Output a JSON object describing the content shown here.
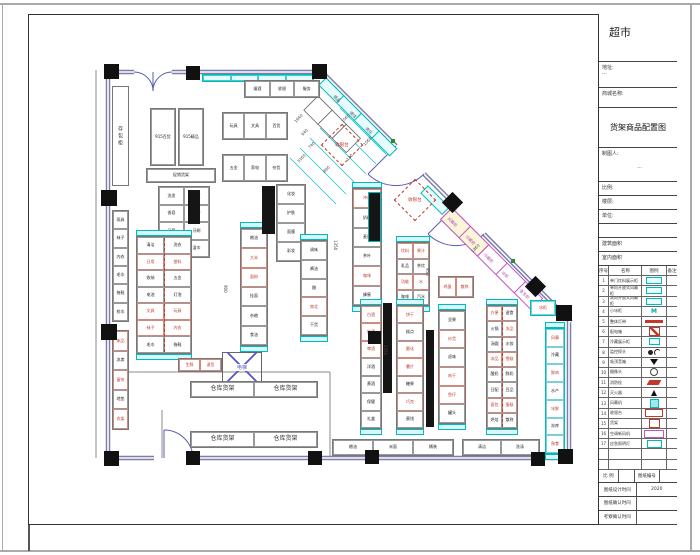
{
  "titleblock": {
    "store_title": "超市",
    "address_label": "地址:",
    "address_value": "···",
    "mall_label": "商城名称:",
    "drawing_title": "货架商品配置图",
    "drafter_label": "制图人:",
    "drafter_value": "···",
    "info_rows": [
      "比例:",
      "楼层:",
      "单位:",
      "",
      "建筑面积",
      "室内面积"
    ],
    "legend": {
      "headers": [
        "序号",
        "名称",
        "图例",
        "备注"
      ],
      "rows": [
        {
          "no": "1",
          "name": "单门饮料展示柜",
          "sym": "cyanbox",
          "note": ""
        },
        {
          "no": "2",
          "name": "单向开放式风幕柜",
          "sym": "cyanbox",
          "note": ""
        },
        {
          "no": "3",
          "name": "双向开放式风幕柜",
          "sym": "cyanbox",
          "note": ""
        },
        {
          "no": "4",
          "name": "小冰柜",
          "sym": "m",
          "note": ""
        },
        {
          "no": "5",
          "name": "整体灯带",
          "sym": "redline",
          "note": ""
        },
        {
          "no": "6",
          "name": "配电箱",
          "sym": "redhatch",
          "note": ""
        },
        {
          "no": "7",
          "name": "冷藏展示柜",
          "sym": "cyansmall",
          "note": ""
        },
        {
          "no": "8",
          "name": "监控探头",
          "sym": "dotarc",
          "note": ""
        },
        {
          "no": "9",
          "name": "吸顶音箱",
          "sym": "speaker",
          "note": ""
        },
        {
          "no": "10",
          "name": "摄像头",
          "sym": "ring",
          "note": ""
        },
        {
          "no": "11",
          "name": "消防栓",
          "sym": "redpara",
          "note": ""
        },
        {
          "no": "12",
          "name": "灭火器",
          "sym": "blacktri",
          "note": ""
        },
        {
          "no": "13",
          "name": "风幕机",
          "sym": "cyanfill",
          "note": ""
        },
        {
          "no": "14",
          "name": "收银台",
          "sym": "redoutline",
          "note": ""
        },
        {
          "no": "15",
          "name": "货架",
          "sym": "redbox",
          "note": ""
        },
        {
          "no": "16",
          "name": "空调新风机",
          "sym": "magenta",
          "note": ""
        },
        {
          "no": "17",
          "name": "应急照明灯",
          "sym": "cyanoutline",
          "note": ""
        },
        {
          "no": "",
          "name": "",
          "sym": "none",
          "note": ""
        },
        {
          "no": "",
          "name": "",
          "sym": "none",
          "note": ""
        }
      ]
    },
    "footer_rows": [
      {
        "cells": [
          "比 例",
          "",
          "图纸编号",
          ""
        ],
        "widths": [
          20,
          16,
          26,
          17
        ]
      },
      {
        "cells": [
          "图纸设计时间",
          "2020"
        ],
        "widths": [
          38,
          41
        ]
      },
      {
        "cells": [
          "图纸确认时间",
          ""
        ],
        "widths": [
          38,
          41
        ]
      },
      {
        "cells": [
          "考察确认时间",
          ""
        ],
        "widths": [
          38,
          41
        ]
      }
    ]
  },
  "plan": {
    "labels": {
      "checkout": "收银台",
      "elevator": "电梯",
      "locker": "存包柜"
    },
    "fridge_run": [
      "风幕柜",
      "冷藏柜",
      "冷藏柜",
      "冰柜",
      "急冻柜"
    ],
    "diag_top": [
      "纸品",
      "清洁",
      "洗化"
    ],
    "runs": [
      {
        "x": 202,
        "y": 74,
        "w": 112,
        "h": 8,
        "dir": "h",
        "cls": "cyan",
        "labels": [
          "",
          "",
          "",
          ""
        ]
      },
      {
        "x": 244,
        "y": 80,
        "w": 76,
        "h": 18,
        "dir": "h",
        "labels": [
          "烟酒",
          "收银",
          "服务"
        ]
      },
      {
        "x": 150,
        "y": 108,
        "w": 26,
        "h": 58,
        "dir": "h",
        "labels": [
          "915百货"
        ]
      },
      {
        "x": 178,
        "y": 108,
        "w": 26,
        "h": 58,
        "dir": "h",
        "labels": [
          "915精品"
        ]
      },
      {
        "x": 146,
        "y": 168,
        "w": 70,
        "h": 15,
        "dir": "h",
        "labels": [
          "促销货架"
        ]
      },
      {
        "x": 222,
        "y": 112,
        "w": 66,
        "h": 28,
        "dir": "h",
        "labels": [
          "玩具",
          "文具",
          "百货"
        ]
      },
      {
        "x": 222,
        "y": 154,
        "w": 66,
        "h": 28,
        "dir": "h",
        "labels": [
          "五金",
          "家电",
          "杂货"
        ]
      },
      {
        "x": 158,
        "y": 186,
        "w": 52,
        "h": 72,
        "cols": 2,
        "labels": [
          "洗发",
          "护发",
          "香皂",
          "沐浴",
          "牙膏",
          "牙刷",
          "纸品",
          "湿巾"
        ]
      },
      {
        "x": 276,
        "y": 184,
        "w": 30,
        "h": 78,
        "cols": 1,
        "labels": [
          "化妆",
          "护肤",
          "面膜",
          "彩妆"
        ]
      },
      {
        "x": 136,
        "y": 236,
        "w": 56,
        "h": 118,
        "cols": 2,
        "caps": 1,
        "mid": 1,
        "red": [
          2,
          3,
          8,
          9,
          10,
          11
        ],
        "labels": [
          "清洁",
          "洗衣",
          "日用",
          "塑料",
          "收纳",
          "五金",
          "电池",
          "灯泡",
          "文具",
          "玩具",
          "袜子",
          "内衣",
          "毛巾",
          "拖鞋"
        ]
      },
      {
        "x": 240,
        "y": 228,
        "w": 28,
        "h": 118,
        "cols": 1,
        "caps": 1,
        "red": [
          1,
          2
        ],
        "labels": [
          "粮油",
          "大米",
          "面粉",
          "挂面",
          "杂粮",
          "食油"
        ]
      },
      {
        "x": 300,
        "y": 240,
        "w": 28,
        "h": 96,
        "cols": 1,
        "caps": 1,
        "red": [
          3
        ],
        "labels": [
          "调味",
          "酱油",
          "醋",
          "南北",
          "干货"
        ]
      },
      {
        "x": 352,
        "y": 188,
        "w": 30,
        "h": 118,
        "cols": 1,
        "caps": 1,
        "red": [
          0,
          4
        ],
        "labels": [
          "冲调",
          "奶粉",
          "麦片",
          "茶叶",
          "咖啡",
          "蜂蜜"
        ]
      },
      {
        "x": 396,
        "y": 242,
        "w": 34,
        "h": 64,
        "cols": 2,
        "caps": 1,
        "red": [
          0,
          1,
          4,
          5
        ],
        "labels": [
          "饮料",
          "果汁",
          "乳品",
          "茶饮",
          "功能",
          "水",
          "咖啡",
          "汽水"
        ]
      },
      {
        "x": 360,
        "y": 305,
        "w": 22,
        "h": 124,
        "cols": 1,
        "caps": 1,
        "red": [
          0,
          1,
          2
        ],
        "labels": [
          "白酒",
          "红酒",
          "啤酒",
          "洋酒",
          "黄酒",
          "保健",
          "礼盒"
        ]
      },
      {
        "x": 396,
        "y": 305,
        "w": 28,
        "h": 124,
        "cols": 1,
        "caps": 1,
        "red": [
          0,
          2,
          3,
          5
        ],
        "labels": [
          "饼干",
          "糕点",
          "膨化",
          "薯片",
          "糖果",
          "巧克",
          "蜜饯"
        ]
      },
      {
        "x": 438,
        "y": 310,
        "w": 28,
        "h": 114,
        "cols": 1,
        "caps": 1,
        "red": [
          1,
          3,
          4
        ],
        "labels": [
          "坚果",
          "炒货",
          "卤味",
          "肉干",
          "鱼仔",
          "罐头"
        ]
      },
      {
        "x": 486,
        "y": 305,
        "w": 32,
        "h": 124,
        "cols": 2,
        "caps": 1,
        "mid": 1,
        "red": [
          0,
          3,
          6,
          7,
          12,
          13
        ],
        "labels": [
          "方便",
          "速食",
          "火锅",
          "冻品",
          "汤圆",
          "水饺",
          "冰品",
          "雪糕",
          "酸奶",
          "鲜奶",
          "日配",
          "豆品",
          "面包",
          "蛋糕",
          "烘焙",
          "散称"
        ]
      },
      {
        "x": 545,
        "y": 328,
        "w": 20,
        "h": 126,
        "cols": 1,
        "caps": 1,
        "cls": "cyan2",
        "red": [
          0,
          2,
          4,
          6
        ],
        "labels": [
          "风幕",
          "冷藏",
          "鲜肉",
          "水产",
          "冰鲜",
          "冻库",
          "熟食"
        ]
      },
      {
        "x": 332,
        "y": 439,
        "w": 122,
        "h": 17,
        "dir": "h",
        "labels": [
          "粮油",
          "米面",
          "桶装"
        ]
      },
      {
        "x": 462,
        "y": 439,
        "w": 78,
        "h": 17,
        "dir": "h",
        "labels": [
          "清洁",
          "洗涤"
        ]
      },
      {
        "x": 190,
        "y": 381,
        "w": 128,
        "h": 17,
        "dir": "h",
        "cls": "wf",
        "labels": [
          "仓库货架",
          "仓库货架"
        ]
      },
      {
        "x": 190,
        "y": 431,
        "w": 128,
        "h": 17,
        "dir": "h",
        "cls": "wf",
        "labels": [
          "仓库货架",
          "仓库货架"
        ]
      },
      {
        "x": 178,
        "y": 358,
        "w": 44,
        "h": 14,
        "dir": "h",
        "red": [
          0,
          1
        ],
        "labels": [
          "生鲜",
          "退货"
        ]
      },
      {
        "x": 112,
        "y": 210,
        "w": 17,
        "h": 112,
        "cols": 1,
        "labels": [
          "雨具",
          "袜子",
          "内衣",
          "毛巾",
          "拖鞋",
          "枕巾"
        ]
      },
      {
        "x": 112,
        "y": 330,
        "w": 17,
        "h": 100,
        "cols": 1,
        "red": [
          0,
          2,
          4
        ],
        "labels": [
          "床品",
          "凉席",
          "窗帘",
          "地垫",
          "衣架"
        ]
      },
      {
        "x": 438,
        "y": 276,
        "w": 36,
        "h": 22,
        "dir": "h",
        "red": [
          0,
          1
        ],
        "labels": [
          "鸡蛋",
          "散称"
        ]
      },
      {
        "x": 530,
        "y": 300,
        "w": 26,
        "h": 16,
        "dir": "h",
        "cls": "cyan2",
        "red": [
          0
        ],
        "labels": [
          "冰柜"
        ]
      }
    ],
    "bars": [
      {
        "x": 188,
        "y": 190,
        "w": 12,
        "h": 34
      },
      {
        "x": 262,
        "y": 186,
        "w": 13,
        "h": 48
      },
      {
        "x": 368,
        "y": 192,
        "w": 13,
        "h": 50,
        "c": 1
      },
      {
        "x": 383,
        "y": 303,
        "w": 9,
        "h": 90
      },
      {
        "x": 426,
        "y": 330,
        "w": 8,
        "h": 97
      }
    ],
    "columns": [
      {
        "x": 104,
        "y": 64,
        "s": 15
      },
      {
        "x": 186,
        "y": 66,
        "s": 14
      },
      {
        "x": 312,
        "y": 64,
        "s": 15
      },
      {
        "x": 101,
        "y": 190,
        "s": 16
      },
      {
        "x": 101,
        "y": 324,
        "s": 16
      },
      {
        "x": 104,
        "y": 451,
        "s": 15
      },
      {
        "x": 186,
        "y": 451,
        "s": 14
      },
      {
        "x": 308,
        "y": 451,
        "s": 14
      },
      {
        "x": 365,
        "y": 450,
        "s": 14
      },
      {
        "x": 531,
        "y": 452,
        "s": 14
      },
      {
        "x": 558,
        "y": 449,
        "s": 15
      },
      {
        "x": 368,
        "y": 331,
        "s": 13
      },
      {
        "x": 445,
        "y": 195,
        "s": 15,
        "rot": 1
      },
      {
        "x": 528,
        "y": 279,
        "s": 15,
        "rot": 1
      },
      {
        "x": 556,
        "y": 305,
        "s": 16
      }
    ],
    "dims": [
      {
        "t": "1640",
        "x": 293,
        "y": 120,
        "r": -45
      },
      {
        "t": "640",
        "x": 300,
        "y": 133,
        "r": -45
      },
      {
        "t": "740",
        "x": 307,
        "y": 146,
        "r": -45
      },
      {
        "t": "3160",
        "x": 296,
        "y": 160,
        "r": -45
      },
      {
        "t": "860",
        "x": 322,
        "y": 170,
        "r": -45
      },
      {
        "t": "130",
        "x": 345,
        "y": 158,
        "r": -45
      },
      {
        "t": "1060",
        "x": 362,
        "y": 143,
        "r": -45
      },
      {
        "t": "1060",
        "x": 340,
        "y": 120,
        "r": -45
      },
      {
        "t": "1860",
        "x": 470,
        "y": 250,
        "r": -45
      },
      {
        "t": "1350",
        "x": 338,
        "y": 240,
        "r": 90
      },
      {
        "t": "950",
        "x": 430,
        "y": 268,
        "r": 90
      },
      {
        "t": "2350",
        "x": 388,
        "y": 345,
        "r": 90
      },
      {
        "t": "900",
        "x": 228,
        "y": 285,
        "r": 90
      }
    ]
  }
}
